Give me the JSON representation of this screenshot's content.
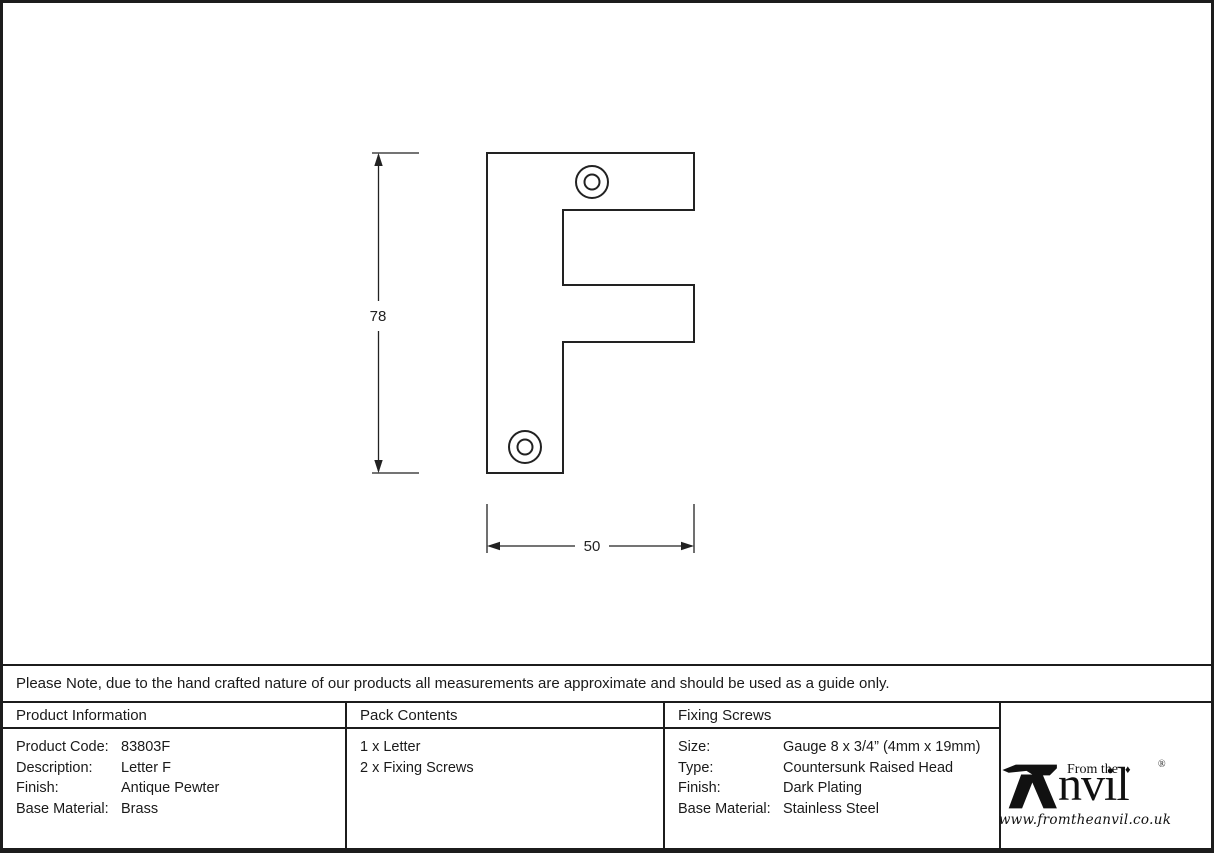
{
  "note": "Please Note, due to the hand crafted nature of our products all measurements are approximate and should be used as a guide only.",
  "drawing": {
    "height_label": "78",
    "width_label": "50"
  },
  "table": {
    "product_information": {
      "header": "Product Information",
      "rows": [
        {
          "label": "Product Code:",
          "value": "83803F"
        },
        {
          "label": "Description:",
          "value": "Letter F"
        },
        {
          "label": "Finish:",
          "value": "Antique Pewter"
        },
        {
          "label": "Base Material:",
          "value": "Brass"
        }
      ]
    },
    "pack_contents": {
      "header": "Pack Contents",
      "items": [
        "1 x Letter",
        "2 x Fixing Screws"
      ]
    },
    "fixing_screws": {
      "header": "Fixing Screws",
      "rows": [
        {
          "label": "Size:",
          "value": "Gauge 8 x 3/4” (4mm x 19mm)"
        },
        {
          "label": "Type:",
          "value": "Countersunk Raised Head"
        },
        {
          "label": "Finish:",
          "value": "Dark Plating"
        },
        {
          "label": "Base Material:",
          "value": "Stainless Steel"
        }
      ]
    }
  },
  "logo": {
    "from_the": "From the",
    "diamond": "♦",
    "brand": "nvil",
    "registered": "®",
    "url": "www.fromtheanvil.co.uk"
  },
  "colors": {
    "line": "#222222",
    "border": "#1c1c1c"
  }
}
